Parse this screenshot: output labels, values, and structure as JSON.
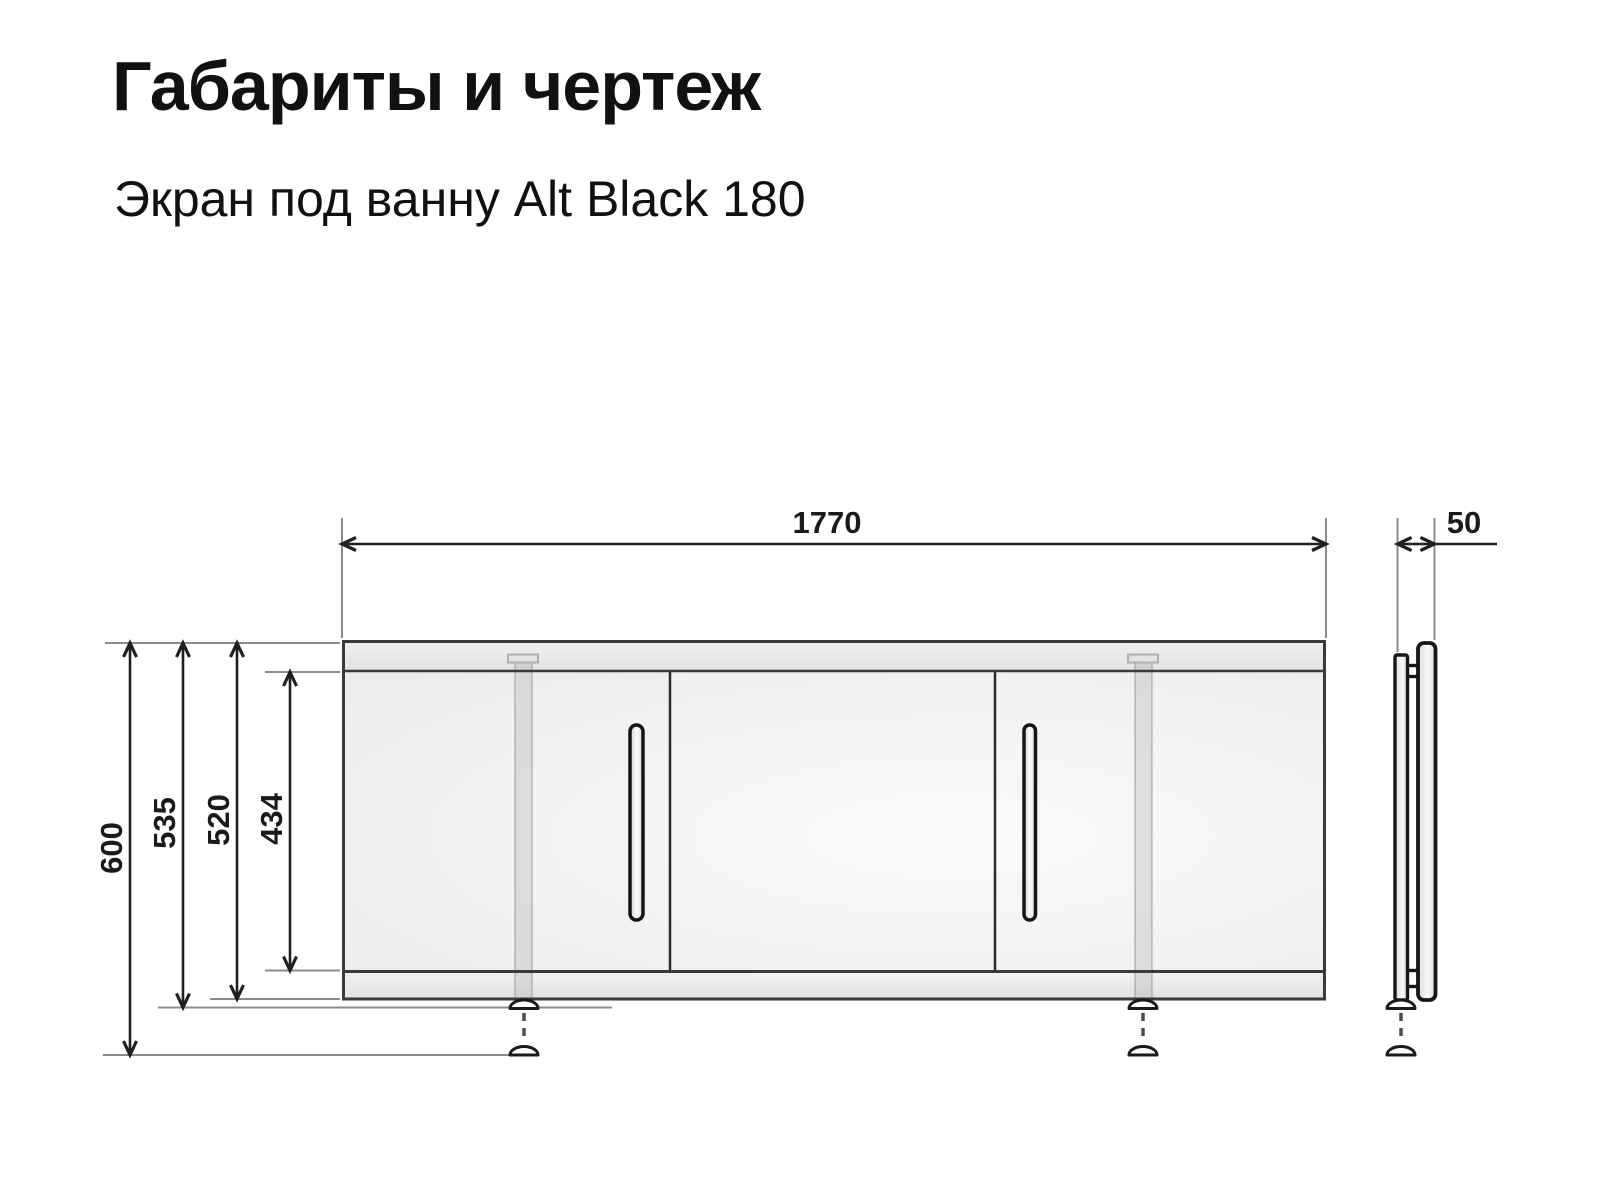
{
  "header": {
    "title": "Габариты и чертеж",
    "subtitle": "Экран под ванну Alt Black 180"
  },
  "drawing": {
    "dims": {
      "overall_width": "1770",
      "depth": "50",
      "overall_height": "600",
      "height_with_foot": "535",
      "frame_height": "520",
      "door_height": "434"
    },
    "colors": {
      "dim_line": "#1f1f1f",
      "ext_line": "#8c8c8c",
      "body_edge": "#3a3a3a",
      "rail_fill": "#e9e9e9",
      "panel_fill": "#f4f4f4",
      "label": "#1a1a1a"
    }
  }
}
